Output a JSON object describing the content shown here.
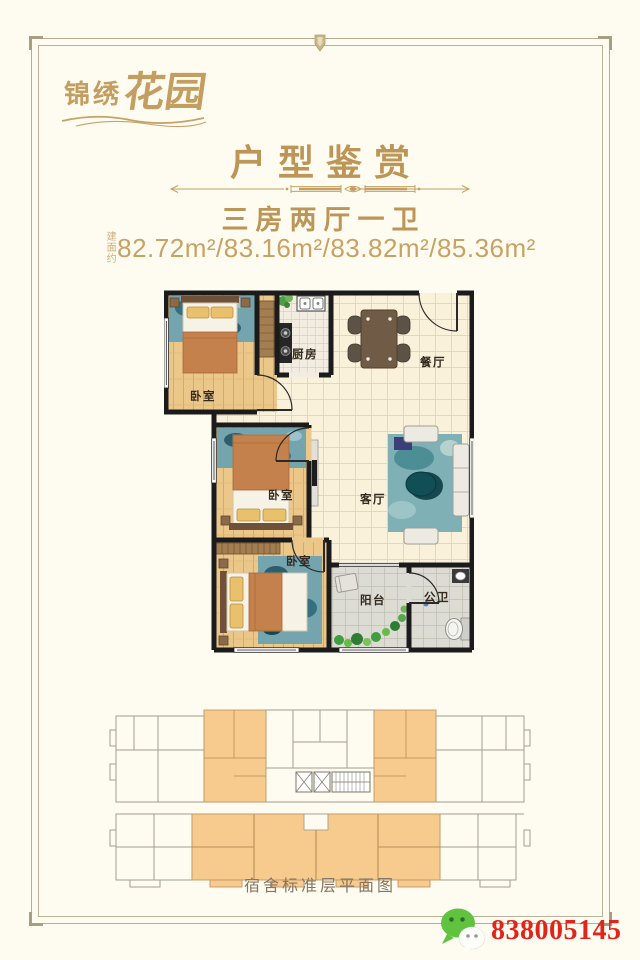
{
  "colors": {
    "background": "#fefcf0",
    "accent_gold": "#bd9557",
    "frame_line": "#b5ae93",
    "wall_black": "#1b1b1b",
    "unit_highlight_orange": "#f7ca8e",
    "wechat_green": "#5fc33f",
    "watermark_red": "#e1251b"
  },
  "logo": {
    "part1": "锦绣",
    "part2": "花园"
  },
  "header": {
    "title": "户型鉴赏",
    "layout": "三房两厅一卫",
    "area_prefix": "建面约",
    "areas": "82.72m²/83.16m²/83.82m²/85.36m²"
  },
  "floorplan": {
    "labels": {
      "bedroom_a": "卧室",
      "kitchen": "厨房",
      "dining": "餐厅",
      "bedroom_b": "卧室",
      "living": "客厅",
      "bedroom_c": "卧室",
      "balcony": "阳台",
      "bathroom": "公卫"
    }
  },
  "building": {
    "caption": "宿舍标准层平面图"
  },
  "watermark": {
    "wechat_id": "838005145",
    "icon": "wechat-icon"
  }
}
